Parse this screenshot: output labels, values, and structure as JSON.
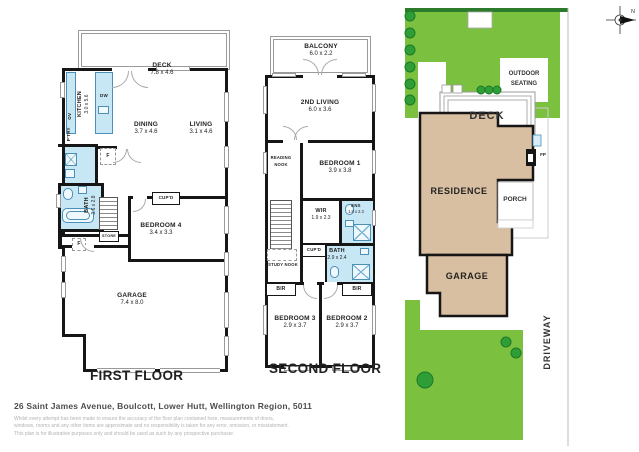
{
  "colors": {
    "wall": "#161616",
    "wet_area_blue": "#c8e7f5",
    "fixture_blue": "#4a90b8",
    "lawn_green": "#7cc03f",
    "lawn_border_green": "#2c7a2c",
    "tree_green": "#2f9e36",
    "building_beige": "#d9bfa1"
  },
  "first_floor": {
    "title": "FIRST FLOOR",
    "deck": {
      "name": "DECK",
      "dims": "7.8 x 4.6"
    },
    "kitchen": {
      "name": "KITCHEN",
      "dims": "3.0 x 5.6"
    },
    "dining": {
      "name": "DINING",
      "dims": "3.7 x 4.6"
    },
    "living": {
      "name": "LIVING",
      "dims": "3.1 x 4.6"
    },
    "bath": {
      "name": "BATH",
      "dims": "3.6 x 2.8"
    },
    "bedroom4": {
      "name": "BEDROOM 4",
      "dims": "3.4 x 3.3"
    },
    "garage": {
      "name": "GARAGE",
      "dims": "7.4 x 8.0"
    },
    "dishwasher": "DW",
    "oven": "OV",
    "pantry": "P'TRY",
    "cupboard": "CUP'D",
    "store": "STORE",
    "fridge": "F",
    "entry_fridge": "F"
  },
  "second_floor": {
    "title": "SECOND FLOOR",
    "balcony": {
      "name": "BALCONY",
      "dims": "6.0 x 2.2"
    },
    "second_living": {
      "name": "2ND LIVING",
      "dims": "6.0 x 3.6"
    },
    "bedroom1": {
      "name": "BEDROOM 1",
      "dims": "3.9 x 3.8"
    },
    "wir": {
      "name": "WIR",
      "dims": "1.9 x 2.3"
    },
    "ensuite": {
      "name": "ENS",
      "dims": "1.8 x 2.3"
    },
    "bath": {
      "name": "BATH",
      "dims": "2.9 x 2.4"
    },
    "bedroom3": {
      "name": "BEDROOM 3",
      "dims": "2.9 x 3.7"
    },
    "bedroom2": {
      "name": "BEDROOM 2",
      "dims": "2.9 x 3.7"
    },
    "reading_nook": "READING NOOK",
    "study_nook": "STUDY NOOK",
    "cupboard": "CUP'D",
    "bir_left": "BIR",
    "bir_right": "BIR"
  },
  "site_plan": {
    "residence": "RESIDENCE",
    "garage": "GARAGE",
    "deck": "DECK",
    "porch": "PORCH",
    "outdoor_seating": "OUTDOOR SEATING",
    "driveway": "DRIVEWAY",
    "fireplace": "FP",
    "compass_north": "N"
  },
  "footer": {
    "address": "26 Saint James Avenue, Boulcott, Lower Hutt, Wellington Region, 5011",
    "disclaimer_line1": "Whilst every attempt has been made to ensure the accuracy of the floor plan contained here, measurements of doors,",
    "disclaimer_line2": "windows, rooms and any other items are approximate and no responsibility is taken for any error, omission, or misstatement.",
    "disclaimer_line3": "This plan is for illustrative purposes only and should be used as such by any prospective purchaser."
  }
}
